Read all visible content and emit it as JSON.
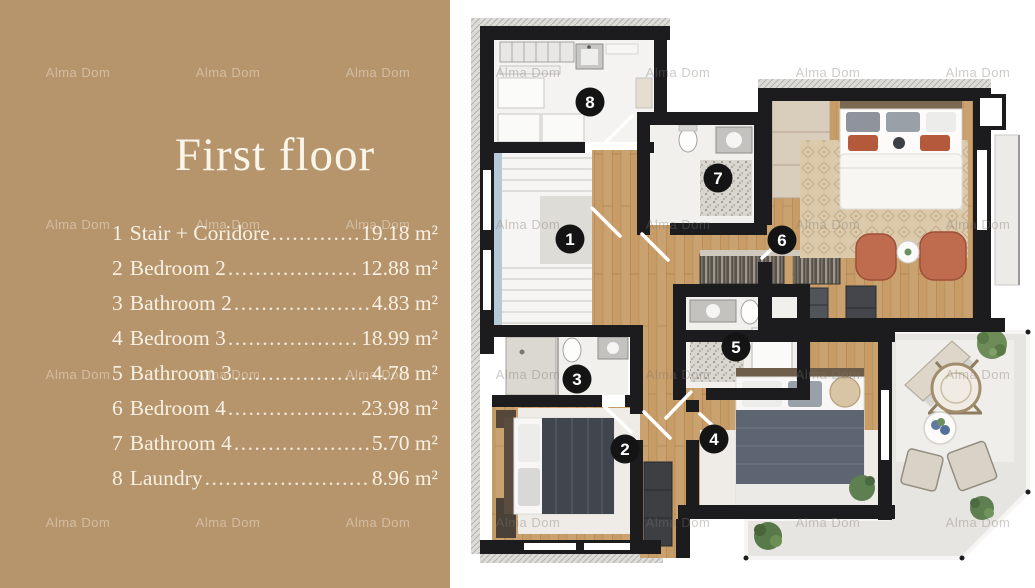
{
  "title": "First floor",
  "watermark": {
    "text": "Alma Dom"
  },
  "legend": {
    "items": [
      {
        "num": "1",
        "name": "Stair + Coridore",
        "area": "19.18 m²"
      },
      {
        "num": "2",
        "name": "Bedroom 2",
        "area": "12.88 m²"
      },
      {
        "num": "3",
        "name": "Bathroom 2",
        "area": "4.83 m²"
      },
      {
        "num": "4",
        "name": "Bedroom 3",
        "area": "18.99 m²"
      },
      {
        "num": "5",
        "name": "Bathroom 3",
        "area": "4.78 m²"
      },
      {
        "num": "6",
        "name": "Bedroom 4",
        "area": "23.98 m²"
      },
      {
        "num": "7",
        "name": "Bathroom 4",
        "area": "5.70 m²"
      },
      {
        "num": "8",
        "name": "Laundry",
        "area": "8.96 m²"
      }
    ]
  },
  "plan": {
    "badges": [
      {
        "n": "1",
        "room": "stair-corridor",
        "x": 570,
        "y": 239
      },
      {
        "n": "2",
        "room": "bedroom-2",
        "x": 625,
        "y": 449
      },
      {
        "n": "3",
        "room": "bathroom-2",
        "x": 577,
        "y": 379
      },
      {
        "n": "4",
        "room": "bedroom-3",
        "x": 714,
        "y": 439
      },
      {
        "n": "5",
        "room": "bathroom-3",
        "x": 736,
        "y": 347
      },
      {
        "n": "6",
        "room": "bedroom-4",
        "x": 782,
        "y": 240
      },
      {
        "n": "7",
        "room": "bathroom-4",
        "x": 718,
        "y": 178
      },
      {
        "n": "8",
        "room": "laundry",
        "x": 590,
        "y": 102
      }
    ]
  },
  "colors": {
    "panel_tan": "#b6946c",
    "panel_text": "#f7f1e4",
    "wall_black": "#1c1c1e",
    "wood_floor": "#c79c66",
    "bath_floor": "#f1f0ed",
    "terrace": "#e7e5e1",
    "accent_terracotta": "#bf6b4d",
    "badge": "#141414"
  }
}
